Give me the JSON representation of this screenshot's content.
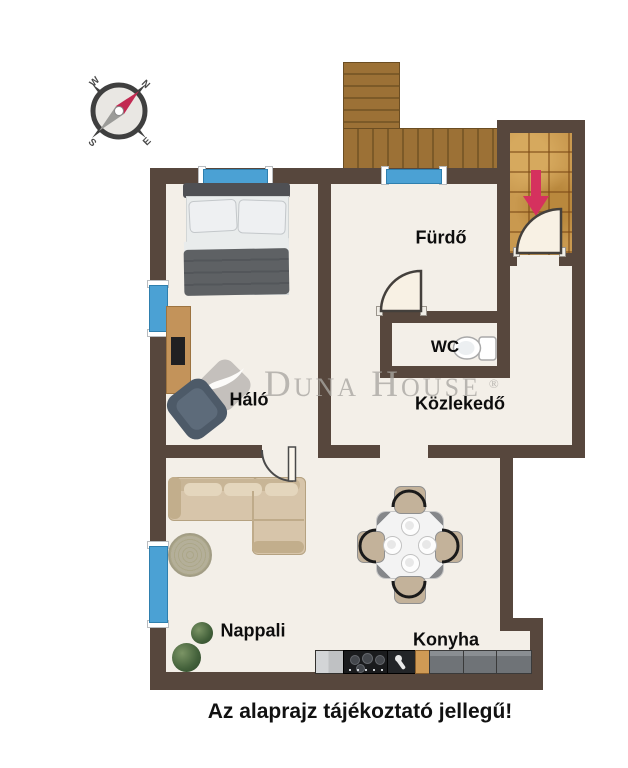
{
  "compass": {
    "n": "N",
    "e": "E",
    "s": "S",
    "w": "W"
  },
  "rooms": {
    "bedroom": "Háló",
    "bathroom": "Fürdő",
    "wc": "WC",
    "hallway": "Közlekedő",
    "living_room": "Nappali",
    "kitchen": "Konyha"
  },
  "watermark": {
    "brand": "Duna House",
    "registered": "®"
  },
  "disclaimer": "Az alaprajz tájékoztató jellegű!",
  "colors": {
    "wall": "#57473d",
    "floor": "#f3efe8",
    "window": "#4ba1d4",
    "entry_arrow": "#d5315e",
    "deck_wood": "#9a7034",
    "porch_tile": "#c9994f",
    "watermark_gray": "#aaa7a2"
  },
  "icons": {
    "compass": "compass-icon",
    "entry_arrow": "entry-arrow-icon",
    "toilet": "toilet-icon",
    "plants": "plant-icon"
  }
}
